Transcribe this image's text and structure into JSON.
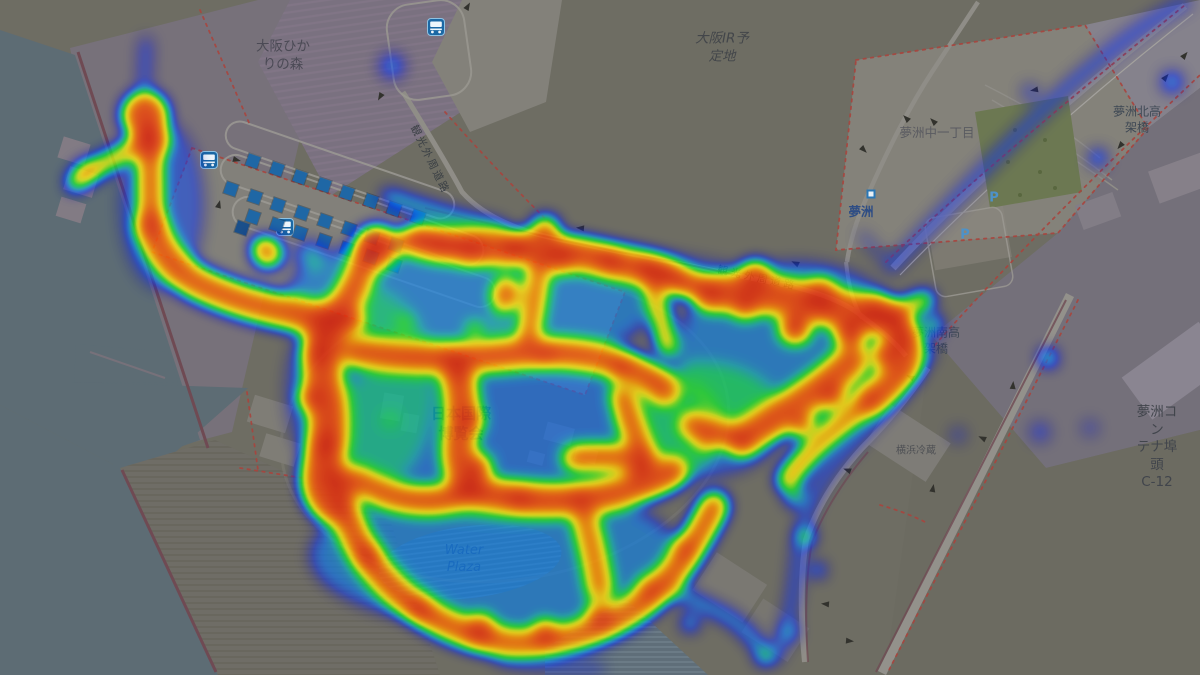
{
  "map": {
    "labels": [
      {
        "id": "label-osaka-hikari-no-mori",
        "text": "大阪ひか\nりの森",
        "x": 283,
        "y": 56,
        "size": 13.5,
        "color": "#4b4a55"
      },
      {
        "id": "label-osaka-ir-yoteichi",
        "text": "大阪IR予\n定地",
        "x": 722,
        "y": 48,
        "size": 13.5,
        "color": "#43464a",
        "italic": true
      },
      {
        "id": "label-yumeshima-naka-1",
        "text": "夢洲中一丁目",
        "x": 937,
        "y": 133,
        "size": 12.5,
        "color": "#5a5b61"
      },
      {
        "id": "label-yumeshima-station",
        "text": "夢洲",
        "x": 861,
        "y": 212,
        "size": 12.5,
        "color": "#2e4d85",
        "bold": true
      },
      {
        "id": "label-yumeshima-kita-kokakyo",
        "text": "夢洲北高\n架橋",
        "x": 1137,
        "y": 120,
        "size": 12,
        "color": "#3e4854"
      },
      {
        "id": "label-yumeshima-minami-kokakyo",
        "text": "夢洲南高\n架橋",
        "x": 936,
        "y": 341,
        "size": 12,
        "color": "#3e4854"
      },
      {
        "id": "label-yumeshima-container-c12",
        "text": "夢洲コン\nテナ埠頭\nC-12",
        "x": 1157,
        "y": 448,
        "size": 13.5,
        "color": "#41454c"
      },
      {
        "id": "label-yokohama-reizo",
        "text": "横浜冷蔵",
        "x": 916,
        "y": 451,
        "size": 10,
        "color": "#4e5054"
      },
      {
        "id": "label-expo-nihon-kokusai-hakurankai",
        "text": "日本国際\n博覧会",
        "x": 461,
        "y": 424,
        "size": 15,
        "color": "#2d3a63",
        "bold": true
      },
      {
        "id": "label-water-plaza",
        "text": "Water\nPlaza",
        "x": 464,
        "y": 560,
        "size": 13,
        "color": "#3d4f73",
        "italic": true
      },
      {
        "id": "label-kanko-gaishu-doro-west",
        "text": "観光外周道路",
        "x": 429,
        "y": 160,
        "size": 10.5,
        "color": "#3b4045",
        "rot": 64,
        "ls": 2
      },
      {
        "id": "label-kanko-gaishu-doro-east",
        "text": "観光外周道路",
        "x": 757,
        "y": 279,
        "size": 10.5,
        "color": "#3b4045",
        "rot": 12,
        "ls": 3
      }
    ],
    "bus_icons": [
      [
        200,
        151
      ],
      [
        276,
        218
      ],
      [
        427,
        18
      ]
    ],
    "bus_stop_rows": [
      {
        "x0": 253,
        "y0": 161,
        "dx": 23.5,
        "dy": 8,
        "n": 8
      },
      {
        "x0": 231,
        "y0": 189,
        "dx": 23.5,
        "dy": 8,
        "n": 8
      },
      {
        "x0": 253,
        "y0": 217,
        "dx": 23.5,
        "dy": 8,
        "n": 7
      }
    ],
    "extra_markers": [
      [
        242,
        228
      ]
    ],
    "parking_label": "P",
    "parking_positions": [
      [
        994,
        198
      ],
      [
        965,
        235
      ]
    ],
    "station_position": [
      871,
      194
    ],
    "trees": [
      [
        1015,
        130
      ],
      [
        1045,
        140
      ],
      [
        1008,
        162
      ],
      [
        1040,
        172
      ],
      [
        1020,
        195
      ],
      [
        1055,
        188
      ]
    ],
    "arrows": [
      [
        468,
        6,
        -60
      ],
      [
        380,
        97,
        120
      ],
      [
        906,
        118,
        225
      ],
      [
        933,
        121,
        225
      ],
      [
        864,
        150,
        45
      ],
      [
        795,
        263,
        205
      ],
      [
        580,
        228,
        185
      ],
      [
        1185,
        55,
        -50
      ],
      [
        1166,
        77,
        -50
      ],
      [
        1120,
        146,
        130
      ],
      [
        1034,
        90,
        170
      ],
      [
        910,
        377,
        205
      ],
      [
        1013,
        385,
        -85
      ],
      [
        982,
        438,
        205
      ],
      [
        933,
        488,
        -80
      ],
      [
        847,
        470,
        200
      ],
      [
        825,
        604,
        185
      ],
      [
        850,
        641,
        5
      ],
      [
        237,
        160,
        15
      ],
      [
        219,
        204,
        -75
      ]
    ],
    "colors": {
      "land": "#6e6d63",
      "water": "#5d6c74",
      "purple_land": "#7a7180",
      "parcel_light": "#84827a",
      "road": "#8f8d87",
      "boundary_dash": "#a8453e",
      "seawall": "#6f4a53",
      "park": "#6c7852",
      "marker_blue": "#1f67a5",
      "bus_icon_blue": "#1b68a4",
      "label_navy": "#2d3a63"
    }
  },
  "heat": {
    "type": "density-heatmap",
    "colormap": "jet (blue→cyan→green→yellow→orange→red)",
    "ellipses": [
      [
        470,
        300,
        185,
        72,
        0.2
      ],
      [
        520,
        430,
        205,
        88,
        0.18
      ],
      [
        495,
        555,
        185,
        72,
        0.2
      ],
      [
        795,
        350,
        118,
        88,
        0.2
      ],
      [
        360,
        390,
        75,
        105,
        0.13
      ],
      [
        162,
        205,
        42,
        85,
        0.14
      ],
      [
        700,
        420,
        85,
        58,
        0.16
      ]
    ],
    "strokes": [
      [
        "M150,135 Q120,158 95,168 Q82,173 76,182",
        16,
        0.7
      ],
      [
        "M150,138 L151,225",
        22,
        0.78
      ],
      [
        "M151,225 Q162,262 195,282 Q235,302 285,312 Q310,317 330,322",
        30,
        0.8
      ],
      [
        "M144,95 L146,42",
        10,
        0.22
      ],
      [
        "M330,322 Q350,300 362,268 Q370,246 378,240",
        26,
        0.8
      ],
      [
        "M375,250 Q395,240 420,240",
        18,
        0.75
      ],
      [
        "M420,240 Q470,250 520,248 Q570,250 615,262 Q645,268 665,275",
        30,
        0.82
      ],
      [
        "M388,196 Q440,215 500,228",
        12,
        0.38
      ],
      [
        "M565,242 Q650,255 720,268 Q755,275 790,285",
        9,
        0.18
      ],
      [
        "M648,268 Q685,278 712,294",
        24,
        0.8
      ],
      [
        "M330,322 Q318,360 325,395 Q332,430 322,465 Q315,490 332,505",
        36,
        0.84
      ],
      [
        "M355,352 Q430,362 500,355 Q560,348 615,362 Q645,372 665,390",
        26,
        0.8
      ],
      [
        "M505,278 L500,310",
        8,
        0.6
      ],
      [
        "M540,262 Q535,300 528,338",
        18,
        0.78
      ],
      [
        "M650,268 Q658,308 668,348",
        16,
        0.72
      ],
      [
        "M455,365 Q465,400 460,435 Q455,465 470,490",
        30,
        0.82
      ],
      [
        "M470,490 Q530,505 590,498 Q640,490 672,472",
        28,
        0.82
      ],
      [
        "M355,480 Q400,505 440,500 Q458,496 470,490",
        24,
        0.8
      ],
      [
        "M622,395 Q632,428 645,458",
        20,
        0.78
      ],
      [
        "M575,458 Q612,456 645,460",
        22,
        0.8
      ],
      [
        "M692,425 Q718,432 742,440",
        22,
        0.8
      ],
      [
        "M742,440 Q772,420 802,400 Q832,380 852,360",
        30,
        0.8
      ],
      [
        "M710,292 Q760,292 800,300 Q850,312 890,318",
        34,
        0.82
      ],
      [
        "M890,318 Q910,330 908,355 Q900,380 870,400",
        28,
        0.8
      ],
      [
        "M870,400 Q840,425 815,448 Q795,468 788,480",
        20,
        0.7
      ],
      [
        "M890,318 Q910,305 925,300",
        16,
        0.65
      ],
      [
        "M342,495 Q350,545 390,585 Q420,615 458,630 Q500,647 545,642 Q592,636 630,612 Q662,592 683,560 Q700,534 714,506",
        26,
        0.8
      ],
      [
        "M585,520 Q595,555 600,590",
        22,
        0.72
      ],
      [
        "M650,580 Q695,600 730,618 Q750,632 765,655",
        12,
        0.3
      ],
      [
        "M500,660 Q550,672 600,668",
        10,
        0.16
      ],
      [
        "M930,352 C898,398 868,428 840,458 C816,484 802,518 798,553 C795,588 790,625 776,656",
        12,
        0.2
      ],
      [
        "M893,266 C950,205 1010,140 1070,85 C1105,55 1145,22 1185,2",
        13,
        0.18
      ],
      [
        "M862,235 Q875,250 890,266",
        8,
        0.15
      ]
    ],
    "spots": [
      [
        145,
        115,
        22,
        0.85
      ],
      [
        150,
        140,
        18,
        0.85
      ],
      [
        88,
        172,
        10,
        0.55
      ],
      [
        268,
        253,
        14,
        0.7
      ],
      [
        262,
        247,
        8,
        0.8
      ],
      [
        375,
        248,
        20,
        0.85
      ],
      [
        440,
        245,
        14,
        0.85
      ],
      [
        470,
        248,
        16,
        0.9
      ],
      [
        515,
        248,
        14,
        0.88
      ],
      [
        560,
        258,
        14,
        0.88
      ],
      [
        610,
        262,
        12,
        0.85
      ],
      [
        545,
        230,
        13,
        0.75
      ],
      [
        507,
        295,
        14,
        0.72
      ],
      [
        475,
        330,
        7,
        0.55
      ],
      [
        350,
        320,
        12,
        0.9
      ],
      [
        318,
        352,
        14,
        0.95
      ],
      [
        312,
        398,
        12,
        0.92
      ],
      [
        325,
        445,
        14,
        0.95
      ],
      [
        335,
        478,
        14,
        0.92
      ],
      [
        460,
        370,
        10,
        0.85
      ],
      [
        545,
        355,
        10,
        0.85
      ],
      [
        620,
        370,
        10,
        0.8
      ],
      [
        470,
        420,
        12,
        0.88
      ],
      [
        478,
        468,
        12,
        0.9
      ],
      [
        520,
        498,
        12,
        0.9
      ],
      [
        580,
        498,
        10,
        0.85
      ],
      [
        638,
        472,
        10,
        0.85
      ],
      [
        705,
        440,
        10,
        0.6
      ],
      [
        680,
        285,
        10,
        0.8
      ],
      [
        755,
        278,
        16,
        0.85
      ],
      [
        820,
        298,
        18,
        0.9
      ],
      [
        875,
        312,
        16,
        0.9
      ],
      [
        900,
        340,
        14,
        0.85
      ],
      [
        745,
        305,
        12,
        0.9
      ],
      [
        795,
        328,
        14,
        0.95
      ],
      [
        850,
        332,
        14,
        0.95
      ],
      [
        885,
        355,
        12,
        0.9
      ],
      [
        832,
        395,
        12,
        0.88
      ],
      [
        802,
        425,
        10,
        0.85
      ],
      [
        368,
        555,
        12,
        0.92
      ],
      [
        420,
        608,
        12,
        0.9
      ],
      [
        480,
        630,
        14,
        0.9
      ],
      [
        545,
        634,
        12,
        0.9
      ],
      [
        600,
        616,
        12,
        0.85
      ],
      [
        648,
        590,
        10,
        0.8
      ],
      [
        683,
        548,
        10,
        0.75
      ],
      [
        310,
        255,
        14,
        0.25
      ],
      [
        933,
        325,
        9,
        0.45
      ],
      [
        912,
        372,
        8,
        0.28
      ],
      [
        795,
        497,
        9,
        0.42
      ],
      [
        806,
        537,
        8,
        0.5
      ],
      [
        818,
        570,
        7,
        0.35
      ],
      [
        790,
        632,
        8,
        0.28
      ],
      [
        765,
        657,
        8,
        0.35
      ],
      [
        1172,
        82,
        10,
        0.28
      ],
      [
        1098,
        158,
        9,
        0.26
      ],
      [
        1030,
        92,
        8,
        0.18
      ],
      [
        392,
        66,
        13,
        0.2
      ],
      [
        1048,
        358,
        8,
        0.42
      ],
      [
        1048,
        358,
        4,
        0.55
      ],
      [
        1040,
        432,
        10,
        0.16
      ],
      [
        1090,
        428,
        8,
        0.14
      ],
      [
        958,
        435,
        8,
        0.15
      ],
      [
        690,
        623,
        8,
        0.38
      ],
      [
        405,
        323,
        6,
        0.4
      ],
      [
        500,
        330,
        5,
        0.35
      ],
      [
        390,
        420,
        5,
        0.28
      ]
    ]
  }
}
